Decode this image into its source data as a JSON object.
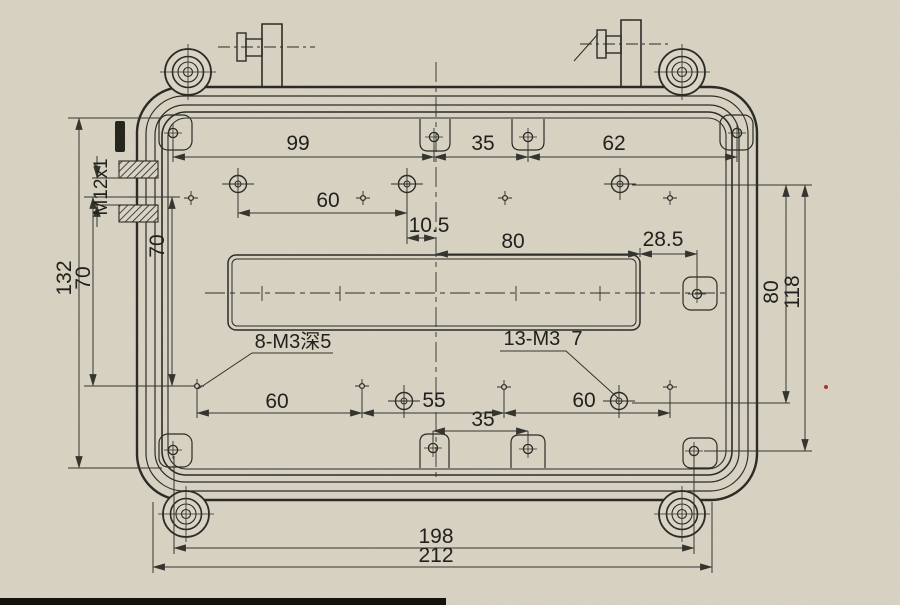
{
  "drawing": {
    "type": "engineering-drawing",
    "subject": "enclosure-box-top-view-with-dimensions",
    "units_implied": "mm",
    "colors": {
      "paper": "#d9d4c4",
      "line": "#2c2c27",
      "dimension": "#35352f",
      "text": "#21211d",
      "scan_strip": "#15120e",
      "red_speck": "#b23324"
    },
    "labels": [
      {
        "id": "dim-99",
        "text": "99",
        "x": 298,
        "y": 150,
        "rot": 0
      },
      {
        "id": "dim-top-35",
        "text": "35",
        "x": 483,
        "y": 150,
        "rot": 0
      },
      {
        "id": "dim-62",
        "text": "62",
        "x": 614,
        "y": 150,
        "rot": 0
      },
      {
        "id": "dim-upper-60",
        "text": "60",
        "x": 328,
        "y": 207,
        "rot": 0
      },
      {
        "id": "dim-10-5",
        "text": "10.5",
        "x": 429,
        "y": 232,
        "rot": 0
      },
      {
        "id": "dim-80-horizontal",
        "text": "80",
        "x": 513,
        "y": 248,
        "rot": 0
      },
      {
        "id": "dim-28-5",
        "text": "28.5",
        "x": 663,
        "y": 246,
        "rot": 0
      },
      {
        "id": "callout-m12x1",
        "text": "M12x1",
        "x": 107,
        "y": 187,
        "rot": -90
      },
      {
        "id": "dim-70-inner",
        "text": "70",
        "x": 164,
        "y": 246,
        "rot": -90
      },
      {
        "id": "dim-132",
        "text": "132",
        "x": 71,
        "y": 278,
        "rot": -90
      },
      {
        "id": "dim-70-outer",
        "text": "70",
        "x": 90,
        "y": 278,
        "rot": -90
      },
      {
        "id": "dim-80-vertical",
        "text": "80",
        "x": 778,
        "y": 292,
        "rot": -90
      },
      {
        "id": "dim-118",
        "text": "118",
        "x": 799,
        "y": 292,
        "rot": -90
      },
      {
        "id": "callout-8-m3-depth5",
        "text": "8-M3深5",
        "x": 293,
        "y": 348,
        "rot": 0
      },
      {
        "id": "callout-13-m3-7",
        "text": "13-M3  7",
        "x": 543,
        "y": 345,
        "rot": 0
      },
      {
        "id": "dim-bottom-60-left",
        "text": "60",
        "x": 277,
        "y": 408,
        "rot": 0
      },
      {
        "id": "dim-55",
        "text": "55",
        "x": 434,
        "y": 407,
        "rot": 0
      },
      {
        "id": "dim-bottom-60-right",
        "text": "60",
        "x": 584,
        "y": 407,
        "rot": 0
      },
      {
        "id": "dim-bottom-35",
        "text": "35",
        "x": 483,
        "y": 426,
        "rot": 0
      },
      {
        "id": "dim-198",
        "text": "198",
        "x": 436,
        "y": 543,
        "rot": 0
      },
      {
        "id": "dim-212",
        "text": "212",
        "x": 436,
        "y": 562,
        "rot": 0
      }
    ]
  }
}
